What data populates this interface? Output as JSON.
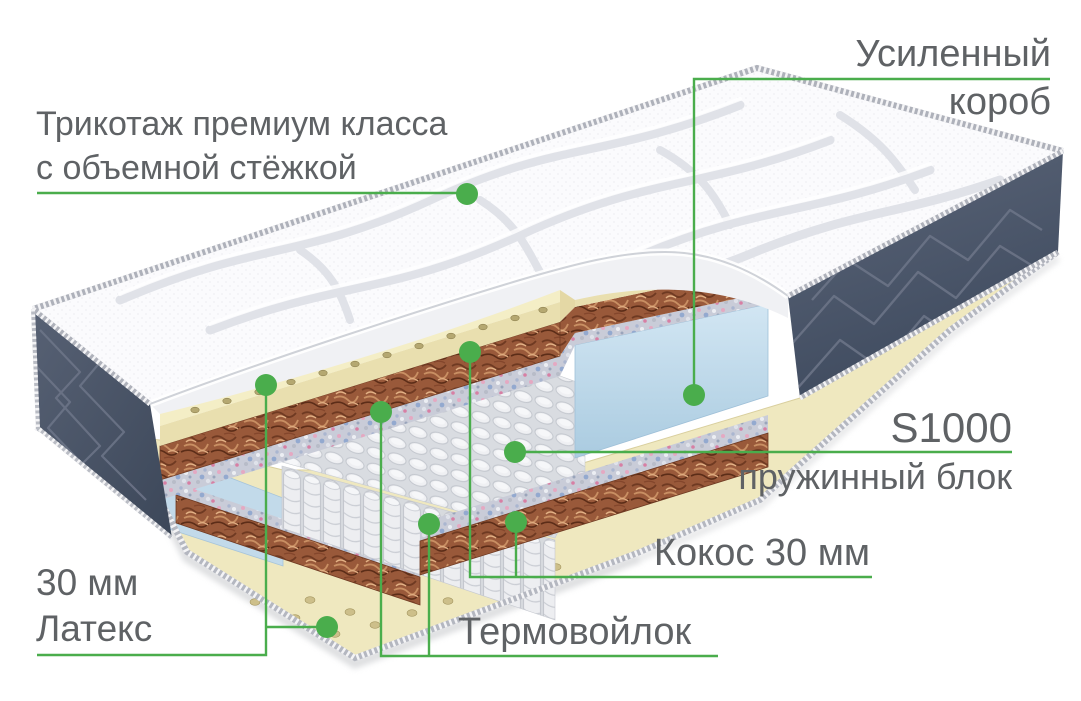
{
  "labels": {
    "cover": {
      "line1": "Трикотаж премиум класса",
      "line2": "с объемной стёжкой"
    },
    "box": {
      "line1": "Усиленный",
      "line2": "короб"
    },
    "springs": {
      "line1": "S1000",
      "line2": "пружинный блок"
    },
    "coconut": {
      "text": "Кокос 30 мм"
    },
    "felt": {
      "text": "Термовойлок"
    },
    "latex": {
      "line1": "30 мм",
      "line2": "Латекс"
    }
  },
  "palette": {
    "accent_green": "#4aad4c",
    "label_text": "#5f6265",
    "quilt_white": "#fbfbfd",
    "side_fabric_navy": "#47536a",
    "latex_cream": "#f4eec6",
    "coconut_brown": "#99593a",
    "felt_speckled_gray": "#c9ccd8",
    "spring_gray": "#edeef1",
    "box_foam_blue": "#c6dff0",
    "piping_gray": "#b4b7c0"
  },
  "callouts": [
    {
      "target": "quilted-cover",
      "label_ref": "cover"
    },
    {
      "target": "reinforced-box",
      "label_ref": "box"
    },
    {
      "target": "spring-block",
      "label_ref": "springs"
    },
    {
      "target": "coconut-layer",
      "label_ref": "coconut"
    },
    {
      "target": "thermo-felt-layer",
      "label_ref": "felt"
    },
    {
      "target": "latex-layer",
      "label_ref": "latex"
    }
  ]
}
